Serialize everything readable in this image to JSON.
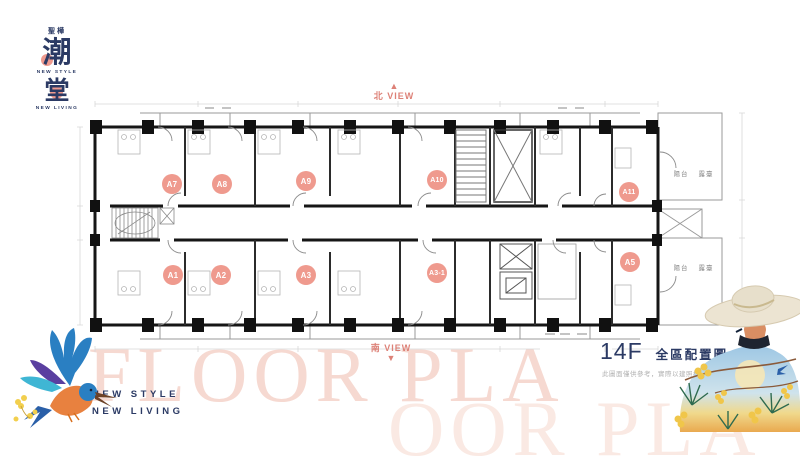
{
  "logo": {
    "top_text": "聖樺",
    "glyph1": "潮",
    "glyph2": "堂",
    "tagline1": "NEW STYLE",
    "tagline2": "NEW LIVING"
  },
  "compass": {
    "north": "北 VIEW",
    "south": "南 VIEW",
    "up_arrow": "▲",
    "down_arrow": "▼"
  },
  "plan": {
    "units": [
      {
        "id": "A7",
        "x": 172,
        "y": 184
      },
      {
        "id": "A8",
        "x": 222,
        "y": 184
      },
      {
        "id": "A9",
        "x": 306,
        "y": 181
      },
      {
        "id": "A10",
        "x": 437,
        "y": 180
      },
      {
        "id": "A11",
        "x": 629,
        "y": 192
      },
      {
        "id": "A1",
        "x": 173,
        "y": 275
      },
      {
        "id": "A2",
        "x": 221,
        "y": 275
      },
      {
        "id": "A3",
        "x": 306,
        "y": 275
      },
      {
        "id": "A3-1",
        "x": 437,
        "y": 273
      },
      {
        "id": "A5",
        "x": 630,
        "y": 262
      }
    ],
    "annotations": [
      {
        "text": "陽台",
        "x": 681,
        "y": 173
      },
      {
        "text": "露臺",
        "x": 706,
        "y": 173
      },
      {
        "text": "陽台",
        "x": 681,
        "y": 267
      },
      {
        "text": "露臺",
        "x": 706,
        "y": 267
      }
    ]
  },
  "watermarks": {
    "primary": "FLOOR PLA",
    "secondary": "OOR PLA"
  },
  "footer_left": {
    "line1": "NEW STYLE",
    "line2": "NEW LIVING"
  },
  "title_block": {
    "floor": "14F",
    "title": "全區配置圖",
    "subtitle": "Floorplan",
    "disclaimer": "此圖面僅供參考，實際以建照核准圖面為準。"
  },
  "colors": {
    "accent": "#dd8177",
    "unit_label_fill": "#ef9a8e",
    "navy": "#2b3a64",
    "watermark_pink": "#f6d9d1"
  }
}
